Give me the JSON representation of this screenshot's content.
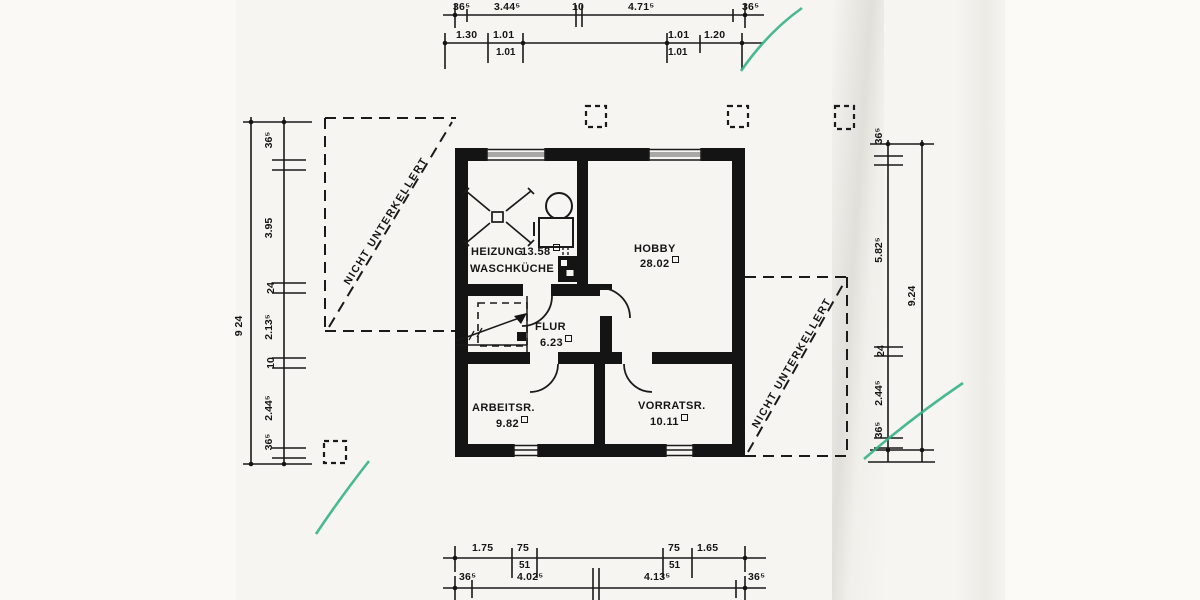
{
  "scan": {
    "type": "architectural floor plan scan (basement level)",
    "ink_color": "#1a1a1a",
    "paper_color": "#f6f5f1",
    "pen_mark_color": "#35b286"
  },
  "regions": {
    "left": {
      "label": "NICHT UNTERKELLERT"
    },
    "right": {
      "label": "NICHT UNTERKELLERT"
    }
  },
  "rooms": {
    "heizung": {
      "name": "HEIZUNG",
      "area": "13.58"
    },
    "waschkueche": {
      "name": "WASCHKÜCHE"
    },
    "hobby": {
      "name": "HOBBY",
      "area": "28.02"
    },
    "flur": {
      "name": "FLUR",
      "area": "6.23"
    },
    "arbeitsraum": {
      "name": "ARBEITSR.",
      "area": "9.82"
    },
    "vorratsraum": {
      "name": "VORRATSR.",
      "area": "10.11"
    }
  },
  "dims": {
    "top1": [
      "36⁵",
      "3.44⁵",
      "10",
      "4.71⁵",
      "36⁵"
    ],
    "top2": [
      "1.30",
      "1.01",
      "1.01",
      "1.20"
    ],
    "top2sub": [
      "1.01",
      "1.01"
    ],
    "bottom1": [
      "1.75",
      "75",
      "75",
      "1.65"
    ],
    "bottom1sub": [
      "51",
      "51"
    ],
    "bottom2": [
      "36⁵",
      "4.02⁵",
      "4.13⁵",
      "36⁵"
    ],
    "left": [
      "36⁵",
      "3.95",
      "24",
      "2.13⁵",
      "10",
      "2.44⁵",
      "36⁵"
    ],
    "left_total": "9 24",
    "right": [
      "36⁵",
      "5.82⁵",
      "24",
      "2.44⁵",
      "36⁵"
    ],
    "right_total": "9.24"
  }
}
